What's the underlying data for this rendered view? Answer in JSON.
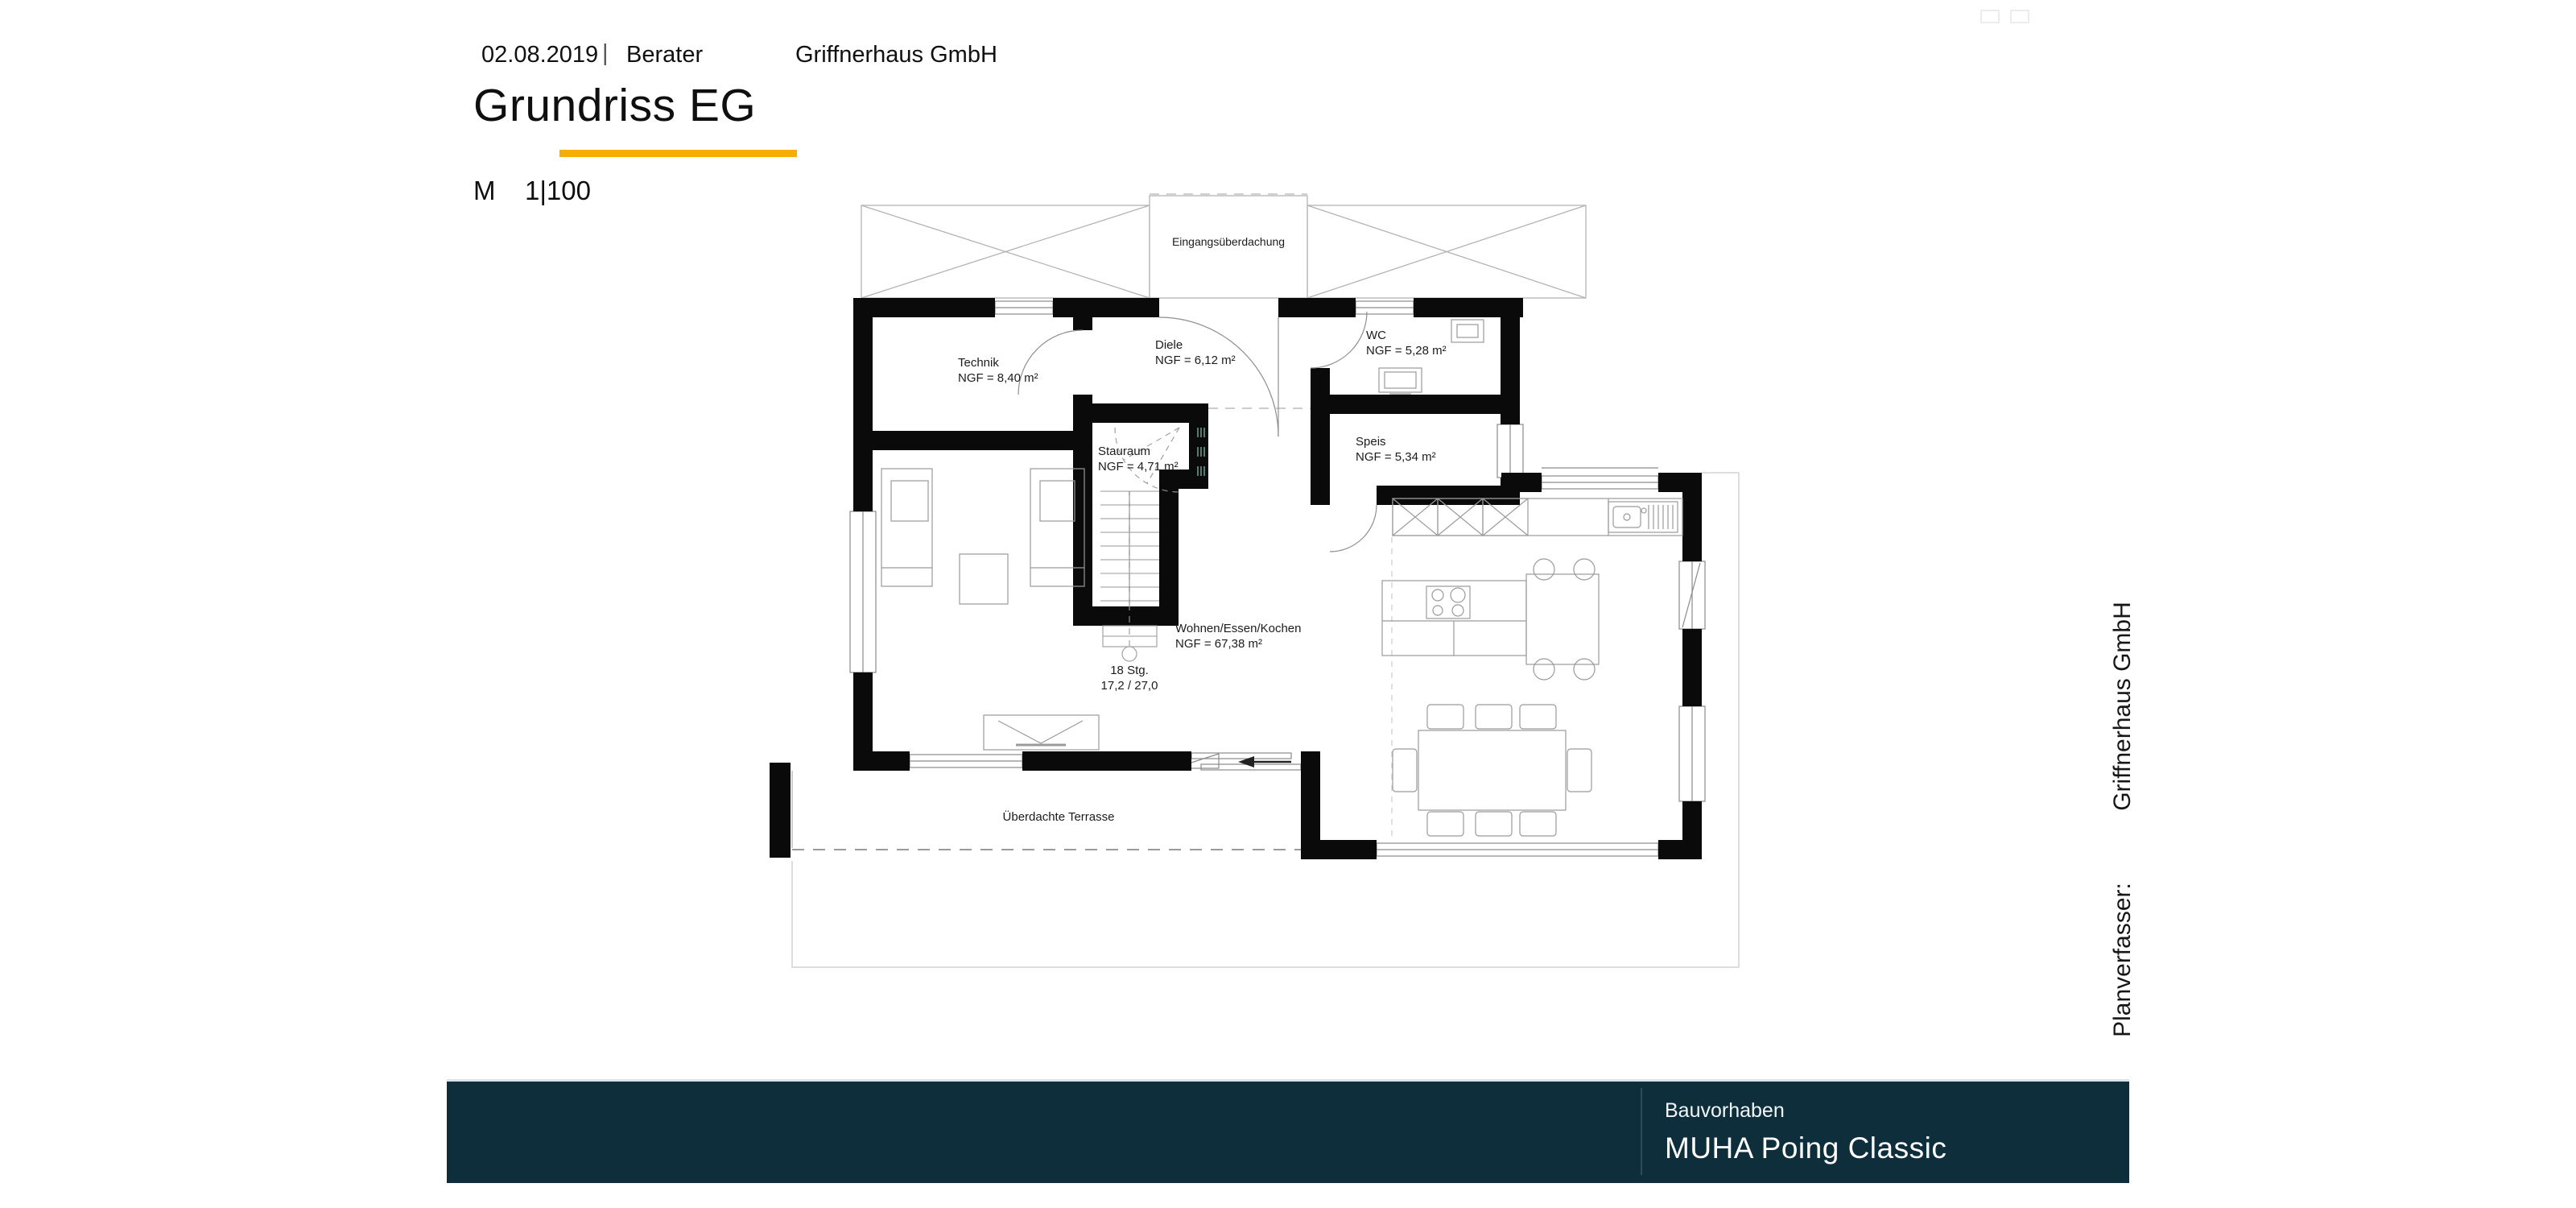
{
  "header": {
    "date": "02.08.2019",
    "separator": "|",
    "advisor": "Berater",
    "company": "Griffnerhaus GmbH",
    "title": "Grundriss EG",
    "scale_label": "M",
    "scale_value": "1|100",
    "accent_color": "#F8AE00"
  },
  "plan": {
    "canopy_label": "Eingangsüberdachung",
    "rooms": [
      {
        "name": "Technik",
        "area": "NGF = 8,40 m²"
      },
      {
        "name": "Diele",
        "area": "NGF = 6,12 m²"
      },
      {
        "name": "WC",
        "area": "NGF = 5,28 m²"
      },
      {
        "name": "Stauraum",
        "area": "NGF = 4,71 m²"
      },
      {
        "name": "Speis",
        "area": "NGF = 5,34 m²"
      },
      {
        "name": "Wohnen/Essen/Kochen",
        "area": "NGF = 67,38 m²"
      }
    ],
    "stairs_line1": "18 Stg.",
    "stairs_line2": "17,2 / 27,0",
    "terrace_label": "Überdachte Terrasse"
  },
  "sidebar": {
    "company_vertical": "Griffnerhaus GmbH",
    "author_label": "Planverfasser:"
  },
  "footer": {
    "project_label": "Bauvorhaben",
    "project_name": "MUHA Poing Classic",
    "bar_color": "#0e2e3b"
  }
}
